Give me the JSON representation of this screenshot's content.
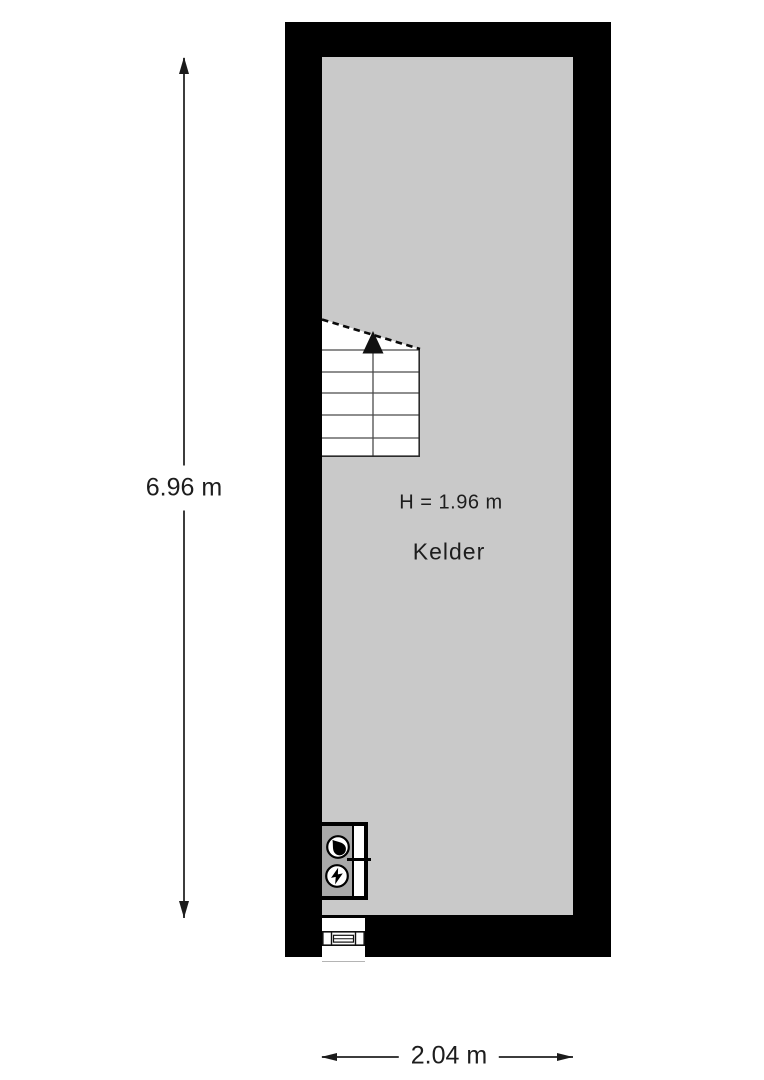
{
  "floorplan": {
    "room": {
      "name": "Kelder",
      "ceiling_height_label": "H = 1.96 m"
    },
    "dimensions": {
      "interior_height_label": "6.96 m",
      "interior_width_label": "2.04 m"
    },
    "features": {
      "staircase": "winder-staircase-with-up-arrow",
      "meter_cupboard": [
        "gas-meter-icon",
        "electric-meter-icon"
      ],
      "window": "window-symbol-in-bottom-wall"
    },
    "colors": {
      "wall": "#000000",
      "floor": "#c9c9c9",
      "stairs_fill": "#ffffff",
      "cupboard_fill": "#a9a9a9",
      "background": "#ffffff",
      "dim_line": "#3c3c3c",
      "text": "#1d1d1d"
    }
  }
}
